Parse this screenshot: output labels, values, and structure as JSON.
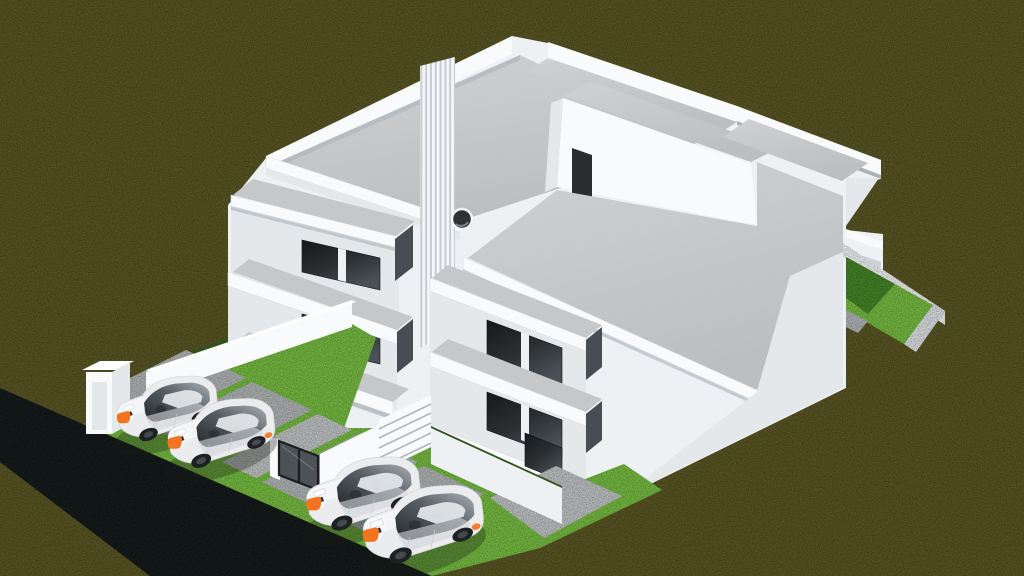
{
  "scene": {
    "type": "3d-architectural-render",
    "description": "Isometric 3D rendering of a modern white two-storey duplex with flat roof terraces, stacked balconies, a vertical louver screen, a porthole window and a rooftop access door; four white sedans with orange markers parked on concrete driveway pads separated by grass strips; a dark asphalt road crosses the lower-left corner of an olive-green grass field; a small walled garden with bright lawn sits at the right side of the house",
    "building": {
      "style": "modern minimalist duplex",
      "storeys": 2,
      "features": [
        "flat roof terraces",
        "white parapets",
        "stacked balconies",
        "vertical louver screen",
        "porthole window",
        "rooftop access door",
        "dark glass sliding windows",
        "entry stairs",
        "entry gate",
        "front fence wall",
        "entrance pillar"
      ]
    },
    "vehicles": {
      "count": 4,
      "type": "sedan",
      "body_color": "white",
      "accent_color": "orange"
    },
    "road": {
      "surface": "dark asphalt",
      "position": "diagonal, lower-left corner"
    },
    "parking": {
      "pads": 4,
      "surface": "concrete",
      "separators": "bright grass strips"
    },
    "garden": {
      "position": "right side of house",
      "enclosure": "low white wall",
      "lawn": "bright green, partly in shadow"
    }
  },
  "palette": {
    "field": "#5e5c2b",
    "road": "#1f2123",
    "lawn": "#7cc246",
    "lawn_shadow": "#4a8a2e",
    "hedge": "#33511f",
    "white_bright": "#f8fafc",
    "white_base": "#eef1f4",
    "white_shade": "#e4e8eb",
    "white_deep": "#cdd3d8",
    "concrete": "#c5c7c9",
    "pad": "#b8bbbd",
    "walkway": "#c7cacb",
    "glass_dark": "#1d2022",
    "glass_mid": "#43484c",
    "car_body": "#eaeced",
    "car_accent": "#f4731e",
    "wheel": "#1e2123",
    "gate": "#4d5256",
    "door": "#2a2d2f",
    "shadow_wedge": "#474d52"
  }
}
